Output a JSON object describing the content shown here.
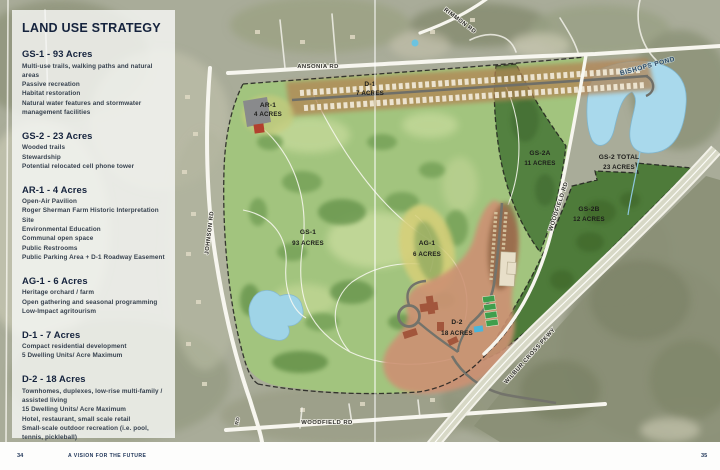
{
  "page": {
    "title": "LAND USE STRATEGY",
    "footer": {
      "page_left": "34",
      "tagline": "A VISION FOR THE FUTURE",
      "page_right": "35"
    }
  },
  "legend": {
    "sections": [
      {
        "heading": "GS-1 - 93 Acres",
        "items": [
          "Multi-use trails, walking paths and natural areas",
          "Passive recreation",
          "Habitat restoration",
          "Natural water features and stormwater management facilities"
        ]
      },
      {
        "heading": "GS-2 - 23 Acres",
        "items": [
          "Wooded trails",
          "Stewardship",
          "Potential relocated cell phone tower"
        ]
      },
      {
        "heading": "AR-1 - 4 Acres",
        "items": [
          "Open-Air Pavilion",
          "Roger Sherman Farm Historic Interpretation Site",
          "Environmental Education",
          "Communal open space",
          "Public Restrooms",
          "Public Parking Area + D-1 Roadway Easement"
        ]
      },
      {
        "heading": "AG-1 - 6 Acres",
        "items": [
          "Heritage orchard / farm",
          "Open gathering and seasonal programming",
          "Low-Impact agritourism"
        ]
      },
      {
        "heading": "D-1 - 7 Acres",
        "items": [
          "Compact residential development",
          "5 Dwelling Units/ Acre Maximum"
        ]
      },
      {
        "heading": "D-2 - 18 Acres",
        "items": [
          "Townhomes, duplexes, low-rise multi-family / assisted living",
          "15 Dwelling Units/ Acre Maximum",
          "Hotel, restaurant, small scale retail",
          "Small-scale outdoor recreation (i.e. pool, tennis, pickleball)",
          "Walking paths and gardens"
        ]
      }
    ]
  },
  "map": {
    "roads": {
      "ansonia": "ANSONIA RD",
      "rimmon": "RIMMON RD",
      "johnson": "JOHNSON RD",
      "woodfield_vertical": "WOODFIELD RD",
      "woodfield_bottom": "WOODFIELD RD",
      "wilbur_cross": "WILBUR CROSS PKWY",
      "rd_fragment": "RD"
    },
    "water": {
      "bishops_pond": "BISHOPS POND"
    },
    "zones": {
      "d1": {
        "line1": "D-1",
        "line2": "7 ACRES"
      },
      "ar1": {
        "line1": "AR-1",
        "line2": "4 ACRES"
      },
      "gs2a": {
        "line1": "GS-2A",
        "line2": "11 ACRES"
      },
      "gs2_total": {
        "line1": "GS-2 TOTAL",
        "line2": "23 ACRES"
      },
      "gs2b": {
        "line1": "GS-2B",
        "line2": "12 ACRES"
      },
      "gs1": {
        "line1": "GS-1",
        "line2": "93 ACRES"
      },
      "ag1": {
        "line1": "AG-1",
        "line2": "6 ACRES"
      },
      "d2": {
        "line1": "D-2",
        "line2": "18 ACRES"
      }
    },
    "colors": {
      "accent_navy": "#15233D",
      "site_green": "#A2C47E",
      "gs2_green": "#4E7B3A",
      "d1_tan": "#B28453",
      "d2_salmon": "#CD9173",
      "ag1_yellow": "#D7CF78",
      "pond_blue": "#A9D9EA",
      "road_white": "#F7F6EF"
    }
  }
}
